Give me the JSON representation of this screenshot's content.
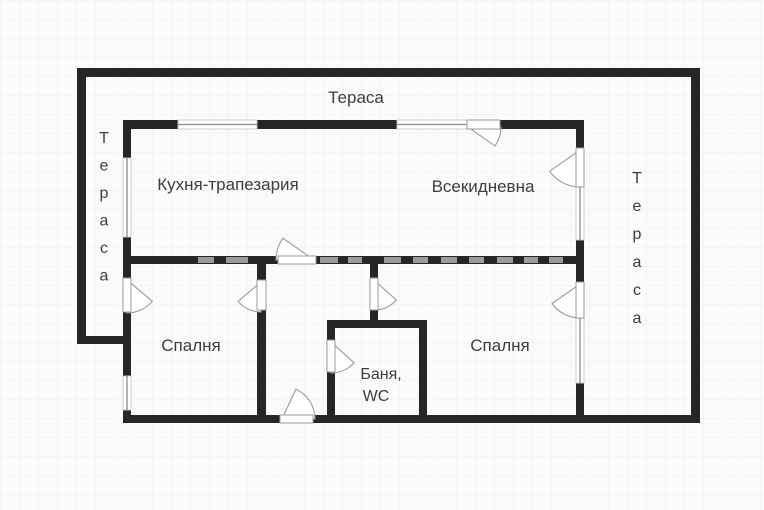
{
  "plan": {
    "canvas": {
      "width": 764,
      "height": 510,
      "background": "#fcfbf9",
      "grid_color": "#f1eeea",
      "grid_size": 19
    },
    "colors": {
      "wall": "#262626",
      "wall_dash": "#9b9b9b",
      "opening_fill": "#ffffff",
      "opening_stroke": "#9a9a9a",
      "window_stroke": "#c9c9c9",
      "glazing_line": "#8a8a8a",
      "label_text": "#3d3d3d"
    },
    "labels": {
      "terrace_top": "Тераса",
      "terrace_left": "Тераса",
      "terrace_right": "Тераса",
      "kitchen": "Кухня-трапезария",
      "living": "Всекидневна",
      "bedroom_left": "Спалня",
      "bedroom_right": "Спалня",
      "bath_line1": "Баня,",
      "bath_line2": "WC"
    },
    "labels_layout": {
      "terrace_top": {
        "x": 356,
        "y": 103,
        "size": 17
      },
      "kitchen": {
        "x": 228,
        "y": 190,
        "size": 17
      },
      "living": {
        "x": 483,
        "y": 192,
        "size": 17
      },
      "bedroom_left": {
        "x": 191,
        "y": 351,
        "size": 17
      },
      "bedroom_right": {
        "x": 500,
        "y": 351,
        "size": 17
      },
      "bath_line1": {
        "x": 381,
        "y": 379,
        "size": 16
      },
      "bath_line2": {
        "x": 376,
        "y": 401,
        "size": 16
      },
      "terrace_left": {
        "x": 104,
        "y": 143,
        "size": 16,
        "vertical": true,
        "spacing": 27.5
      },
      "terrace_right": {
        "x": 637,
        "y": 183,
        "size": 16,
        "vertical": true,
        "spacing": 28
      }
    },
    "walls": [
      {
        "x": 77,
        "y": 68,
        "w": 623,
        "h": 9
      },
      {
        "x": 77,
        "y": 68,
        "w": 9,
        "h": 276
      },
      {
        "x": 77,
        "y": 336,
        "w": 54,
        "h": 8
      },
      {
        "x": 691,
        "y": 68,
        "w": 9,
        "h": 355
      },
      {
        "x": 123,
        "y": 415,
        "w": 577,
        "h": 8
      },
      {
        "x": 123,
        "y": 120,
        "w": 461,
        "h": 9
      },
      {
        "x": 123,
        "y": 120,
        "w": 8,
        "h": 303
      },
      {
        "x": 576,
        "y": 120,
        "w": 8,
        "h": 303
      },
      {
        "x": 123,
        "y": 256,
        "w": 461,
        "h": 8
      },
      {
        "x": 257,
        "y": 256,
        "w": 9,
        "h": 167
      },
      {
        "x": 370,
        "y": 256,
        "w": 8,
        "h": 72
      },
      {
        "x": 327,
        "y": 320,
        "w": 100,
        "h": 8
      },
      {
        "x": 327,
        "y": 320,
        "w": 8,
        "h": 103
      },
      {
        "x": 419,
        "y": 320,
        "w": 8,
        "h": 103
      }
    ],
    "wall_dashes": [
      {
        "x": 198,
        "y": 257,
        "w": 16,
        "h": 6
      },
      {
        "x": 226,
        "y": 257,
        "w": 22,
        "h": 6
      },
      {
        "x": 320,
        "y": 257,
        "w": 18,
        "h": 6
      },
      {
        "x": 348,
        "y": 257,
        "w": 14,
        "h": 6
      },
      {
        "x": 384,
        "y": 257,
        "w": 17,
        "h": 6
      },
      {
        "x": 413,
        "y": 257,
        "w": 15,
        "h": 6
      },
      {
        "x": 441,
        "y": 257,
        "w": 16,
        "h": 6
      },
      {
        "x": 469,
        "y": 257,
        "w": 15,
        "h": 6
      },
      {
        "x": 497,
        "y": 257,
        "w": 16,
        "h": 6
      },
      {
        "x": 524,
        "y": 257,
        "w": 14,
        "h": 6
      },
      {
        "x": 549,
        "y": 257,
        "w": 14,
        "h": 6
      }
    ],
    "windows": [
      {
        "x": 178,
        "y": 120,
        "w": 79,
        "h": 9,
        "orient": "h"
      },
      {
        "x": 397,
        "y": 120,
        "w": 70,
        "h": 9,
        "orient": "h"
      },
      {
        "x": 123,
        "y": 158,
        "w": 8,
        "h": 79,
        "orient": "v"
      },
      {
        "x": 123,
        "y": 376,
        "w": 8,
        "h": 34,
        "orient": "v"
      },
      {
        "x": 576,
        "y": 187,
        "w": 8,
        "h": 53,
        "orient": "v"
      },
      {
        "x": 576,
        "y": 318,
        "w": 8,
        "h": 65,
        "orient": "v"
      }
    ],
    "doors": [
      {
        "name": "living-to-top-terrace",
        "gap": {
          "x": 467,
          "y": 120,
          "w": 33,
          "h": 9
        },
        "apex": [
          468,
          127
        ],
        "r": 33,
        "a1": 0,
        "a2": 35
      },
      {
        "name": "living-to-right-terrace",
        "gap": {
          "x": 576,
          "y": 148,
          "w": 8,
          "h": 39
        },
        "apex": [
          580,
          150
        ],
        "r": 37,
        "a1": 90,
        "a2": 145
      },
      {
        "name": "bedroom-right-to-terrace",
        "gap": {
          "x": 576,
          "y": 282,
          "w": 8,
          "h": 36
        },
        "apex": [
          580,
          284
        ],
        "r": 34,
        "a1": 90,
        "a2": 145
      },
      {
        "name": "bedroom-left-to-terrace",
        "gap": {
          "x": 123,
          "y": 278,
          "w": 8,
          "h": 34
        },
        "apex": [
          127,
          280
        ],
        "r": 33,
        "a1": 90,
        "a2": 40
      },
      {
        "name": "hall-to-bedroom-left",
        "gap": {
          "x": 257,
          "y": 280,
          "w": 9,
          "h": 30
        },
        "apex": [
          261,
          282
        ],
        "r": 30,
        "a1": 90,
        "a2": 140
      },
      {
        "name": "hall-to-bedroom-right",
        "gap": {
          "x": 370,
          "y": 278,
          "w": 8,
          "h": 32
        },
        "apex": [
          374,
          280
        ],
        "r": 30,
        "a1": 90,
        "a2": 42
      },
      {
        "name": "hall-to-bathroom",
        "gap": {
          "x": 327,
          "y": 340,
          "w": 8,
          "h": 32
        },
        "apex": [
          331,
          342
        ],
        "r": 31,
        "a1": 90,
        "a2": 42
      },
      {
        "name": "hall-to-kitchen",
        "gap": {
          "x": 278,
          "y": 256,
          "w": 38,
          "h": 8
        },
        "apex": [
          314,
          260
        ],
        "r": 38,
        "a1": 180,
        "a2": 215
      },
      {
        "name": "entrance",
        "gap": {
          "x": 280,
          "y": 415,
          "w": 33,
          "h": 8
        },
        "apex": [
          282,
          419
        ],
        "r": 33,
        "a1": 0,
        "a2": -65
      }
    ]
  }
}
